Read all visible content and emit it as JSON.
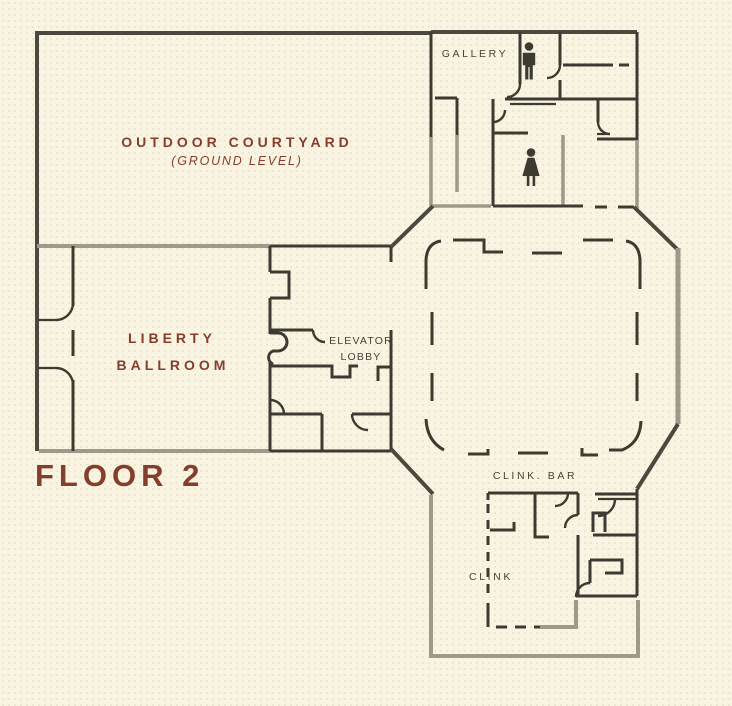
{
  "floor": {
    "label": "FLOOR 2"
  },
  "rooms": {
    "outdoor_courtyard": {
      "label": "OUTDOOR COURTYARD",
      "sublabel": "(GROUND LEVEL)"
    },
    "liberty_ballroom": {
      "line1": "LIBERTY",
      "line2": "BALLROOM"
    },
    "elevator_lobby": {
      "line1": "ELEVATOR",
      "line2": "LOBBY"
    },
    "gallery": {
      "label": "GALLERY"
    },
    "clink_bar": {
      "label": "CLINK. BAR"
    },
    "clink": {
      "label": "CLINK"
    }
  },
  "icons": {
    "mens_restroom": "mens-restroom-icon",
    "womens_restroom": "womens-restroom-icon"
  },
  "colors": {
    "background": "#f9f4e2",
    "wall_dark": "#3d3a31",
    "wall_outer": "#4b4840",
    "wall_gray": "#9d998b",
    "accent_maroon": "#853e2c",
    "label_gray": "#45423a"
  }
}
